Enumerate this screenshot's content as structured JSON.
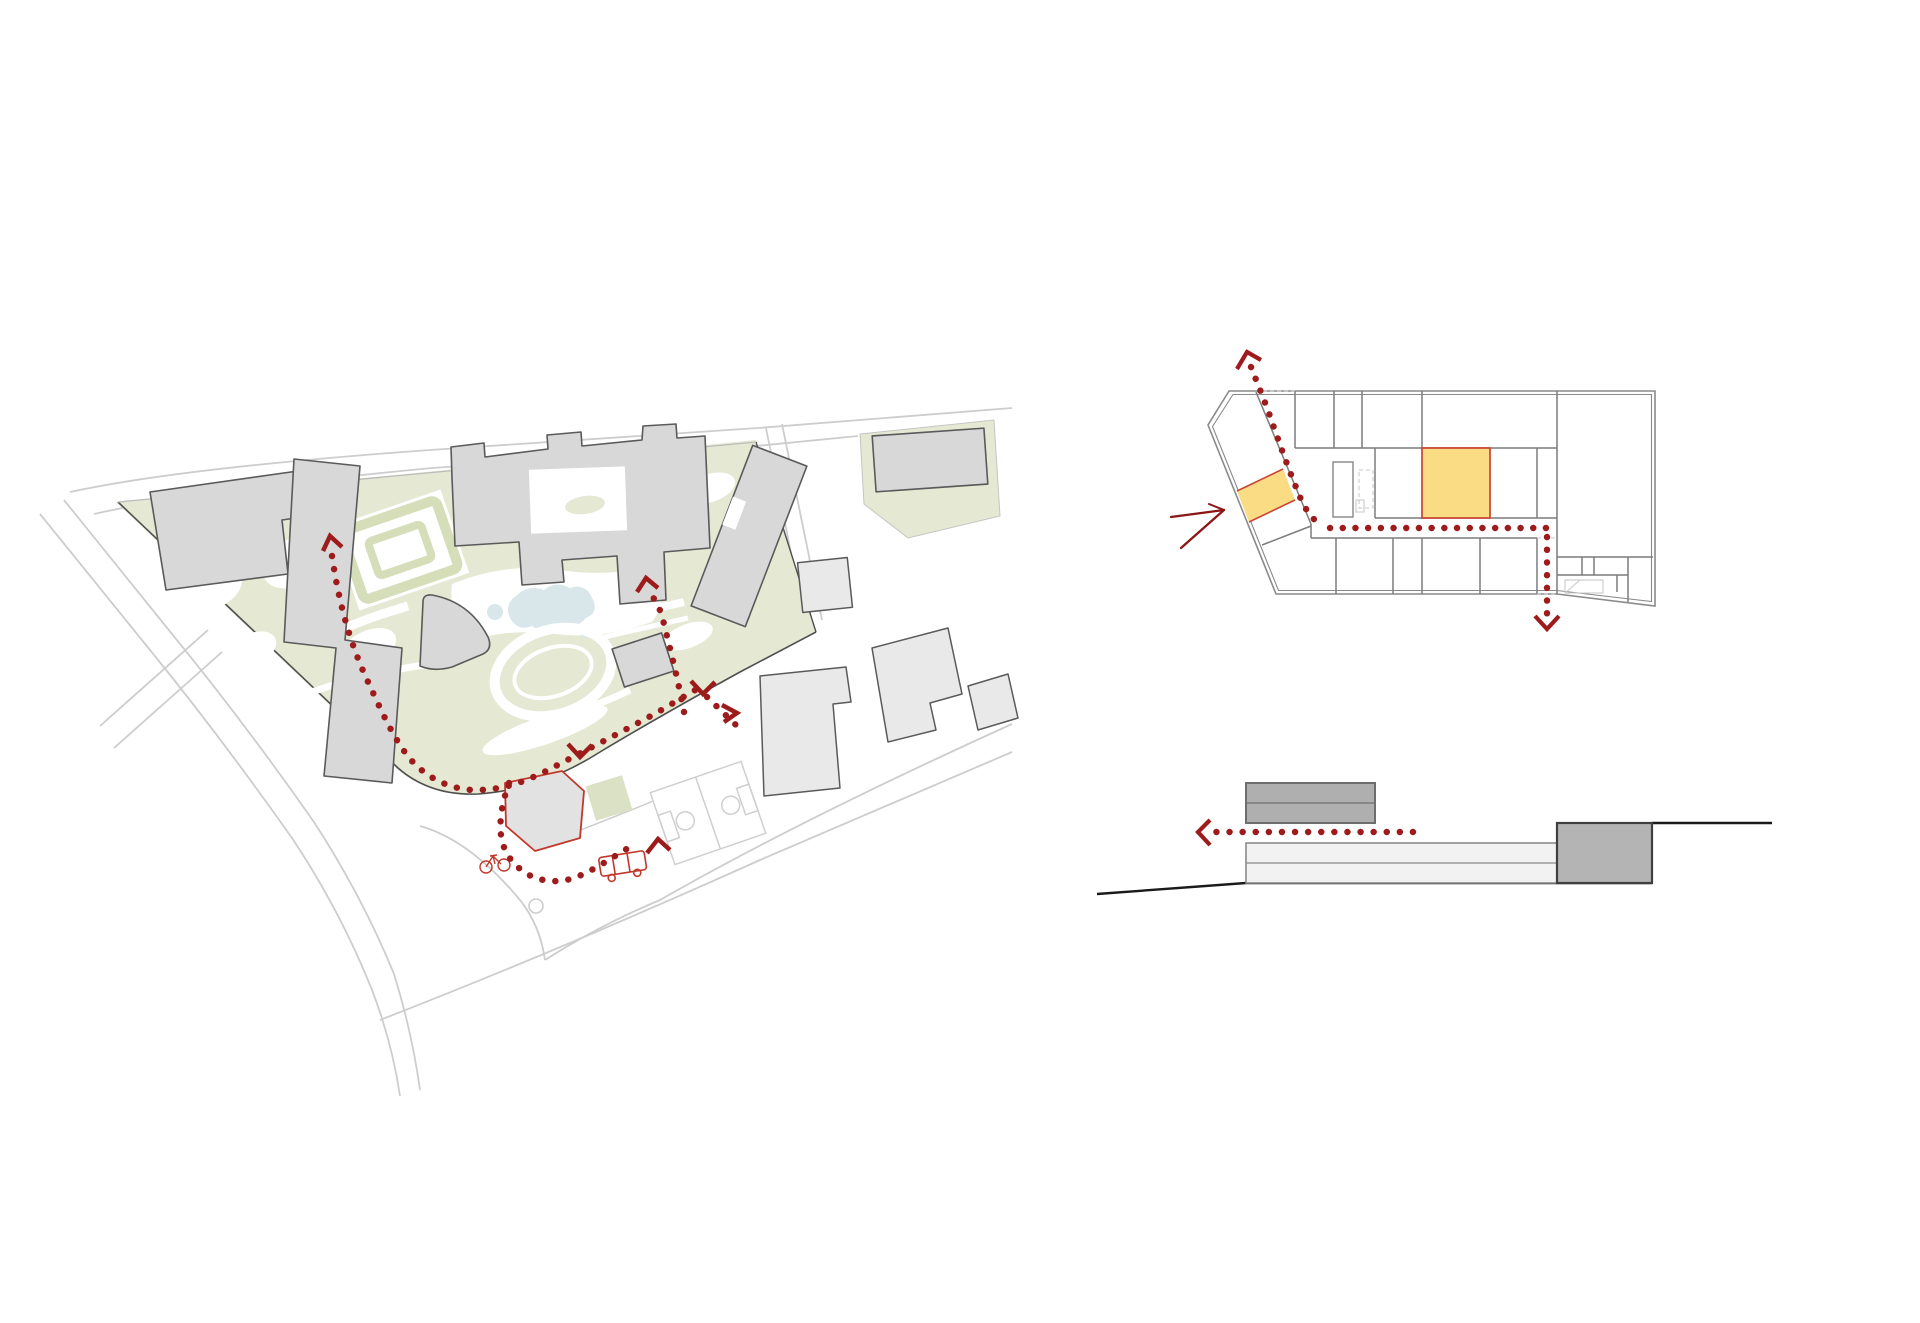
{
  "document": {
    "kind": "architectural circulation diagrams",
    "background": "#ffffff"
  },
  "colors": {
    "path_red": "#9E1B1B",
    "accent_red": "#C0392B",
    "sketch_red": "#8C1616",
    "highlight_yellow": "#FADC85",
    "highlight_border": "#CB4434",
    "campus_green": "#E5E8D2",
    "hedge_green": "#D5DDB9",
    "lawn_green": "#DBE1C4",
    "pond_blue": "#D9E7EA",
    "building_gray": "#D8D8D8",
    "building_light": "#E9E9E9",
    "building_outline": "#5A5A5A",
    "wall_gray": "#7C7C7C",
    "wall_light": "#8A8A8A",
    "boundary_dark": "#4F4F4F",
    "road_gray": "#CDCDCD",
    "court_gray": "#CFCFCF",
    "white": "#FFFFFF",
    "section_light": "#F2F2F2",
    "section_mid": "#AFAFAF",
    "section_dark": "#B4B4B4",
    "ground_black": "#1A1A1A",
    "faint_gray": "#C9C9C9"
  },
  "figures": {
    "site_plan": {
      "label": "site plan with dotted circulation route"
    },
    "floor_plan": {
      "label": "floor plan with dotted route and two highlighted rooms",
      "highlighted_rooms": 2
    },
    "section": {
      "label": "site section with dotted entry arrow",
      "volumes": 3
    }
  },
  "icons": {
    "bus": "bus-icon",
    "bicycle": "bicycle-icon",
    "chevron": "route-direction-chevron",
    "sketch_arrow": "entrance-sketch-arrow"
  },
  "route": {
    "style": "dotted",
    "dot_diameter_px": 6.4,
    "dot_spacing_px": 13
  }
}
